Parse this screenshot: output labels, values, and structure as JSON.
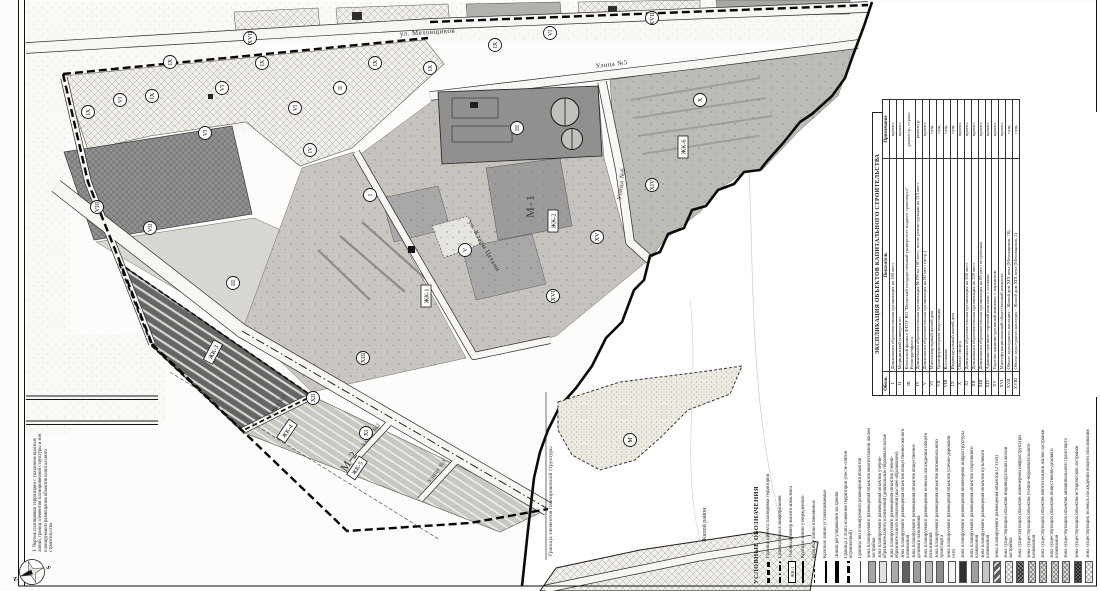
{
  "sheet": {
    "note": "1. Чертеж планировки территории с указанием красных линий, границ элементов планировочной структуры и зон планируемого размещения объектов капитального строительства",
    "compass": {
      "north": "N",
      "south": "S"
    }
  },
  "map": {
    "streets": [
      "ул. Меховщиков",
      "Улица №5",
      "Улица №6",
      "ул. Клары Цеткин",
      "Улица №1",
      "Улица №2",
      "Улица №3"
    ],
    "district_labels": [
      "М-1",
      "М-2"
    ],
    "housing_complex_labels": [
      "ЖК-1",
      "ЖК-2",
      "ЖК-3",
      "ЖК-4",
      "ЖК-5",
      "ЖК-6"
    ],
    "markers": [
      "IX",
      "VI",
      "IX",
      "VI",
      "IX",
      "VI",
      "II",
      "IX",
      "IX",
      "IX",
      "VI",
      "IX",
      "VII",
      "VIII",
      "IV",
      "I",
      "III",
      "V",
      "XVI",
      "XV",
      "XIV",
      "X",
      "XIII",
      "XII",
      "XI",
      "XVII",
      "XVIII",
      "М",
      "III",
      "VI"
    ],
    "annotations": [
      "Жилой район",
      "Граница элементов планировочной структуры"
    ]
  },
  "legend": {
    "title": "УСЛОВНЫЕ ОБОЗНАЧЕНИЯ",
    "items": [
      {
        "label": "Граница проекта планировки территории",
        "swatch": "line-bold-dash"
      },
      {
        "label": "Граница жилых микрорайонов",
        "swatch": "line-dash-dot"
      },
      {
        "label": "Условный номер жилого комплекса",
        "swatch": "zk-box",
        "sample": "ЖК-1"
      },
      {
        "label": "Красные линии утвержденные",
        "swatch": "line-solid"
      },
      {
        "label": "Красные линии отменяемые",
        "swatch": "line-dash-thin"
      },
      {
        "label": "Красные линии устанавливаемые",
        "swatch": "line-solid-thick"
      },
      {
        "label": "Линии регулирования застройки",
        "swatch": "line-bar"
      },
      {
        "label": "Граница 2 этапа освоения территории (после снятия ограничений)",
        "swatch": "line-bold-dash2"
      },
      {
        "label": "Граница зон планируемого размещения объектов",
        "swatch": "line-thin"
      },
      {
        "label": "Зона планируемого размещения объектов многоэтажной жилой застройки",
        "swatch": "fill",
        "fill": "#a6a6a6"
      },
      {
        "label": "Зона планируемого размещения объектов учебно-образовательного назначения (дошкольные образовательные организации)",
        "swatch": "fill",
        "fill": "#e0e0e0"
      },
      {
        "label": "Зона планируемого размещения объектов учебно-образовательного назначения (высшее образование)",
        "swatch": "fill",
        "fill": "#ababab"
      },
      {
        "label": "Зона планируемого размещения объектов общественно-жилого назначения",
        "swatch": "fill",
        "fill": "#606060"
      },
      {
        "label": "Зона планируемого размещения объектов общественно-делового назначения",
        "swatch": "fill",
        "fill": "#9b9b9b"
      },
      {
        "label": "Зона планируемого размещения зеленых насаждений общего пользования",
        "swatch": "fill",
        "fill": "#bcbcbc"
      },
      {
        "label": "Зона планируемого размещения объектов автомобильного транспорта",
        "swatch": "fill",
        "fill": "#8d8d8d"
      },
      {
        "label": "Зона планируемого размещения объектов улично-дорожной сети",
        "swatch": "fill",
        "fill": "#f4f4f4"
      },
      {
        "label": "Зона планируемого размещения инженерной инфраструктуры",
        "swatch": "fill",
        "fill": "#303030"
      },
      {
        "label": "Зона планируемого размещения объектов спортивного назначения",
        "swatch": "fill",
        "fill": "#a0a0a0"
      },
      {
        "label": "Зона планируемого размещения объектов культового назначения",
        "swatch": "fill",
        "fill": "#c6c6c6"
      },
      {
        "label": "Зоны планируемого размещения объектов (2 этап)",
        "swatch": "hatch-stage2"
      },
      {
        "label": "Зона существующих объектов индивидуальной жилой застройки",
        "swatch": "hatch-cross-light"
      },
      {
        "label": "Зона существующих объектов инженерной инфраструктуры",
        "swatch": "hatch-cross-dark"
      },
      {
        "label": "Зона существующих объектов учебно-образовательного назначения",
        "swatch": "hatch-cross-med"
      },
      {
        "label": "Зона существующих объектов многоэтажной жилой застройки",
        "swatch": "hatch-cross-med"
      },
      {
        "label": "Зона существующих объектов общественно-делового назначения",
        "swatch": "hatch-cross-med"
      },
      {
        "label": "Зона существующих объектов автомобильного транспорта",
        "swatch": "hatch-cross-med"
      },
      {
        "label": "Зона существующих объектов исторической застройки",
        "swatch": "hatch-cross-dark2"
      },
      {
        "label": "Зона существующих зеленых насаждений общего пользования",
        "swatch": "hatch-cross-light"
      }
    ]
  },
  "table": {
    "title": "ЭКСПЛИКАЦИЯ ОБЪЕКТОВ КАПИТАЛЬНОГО СТРОИТЕЛЬСТВА",
    "columns": [
      "Обозн.",
      "Показатель",
      "Примечание"
    ],
    "rows": [
      [
        "I",
        "Дошкольная образовательная организация на 180 мест",
        "проект."
      ],
      [
        "II",
        "Медицинский университет",
        "проект."
      ],
      [
        "III",
        "Казанский филиал ФГОУ ВО \"Волжский государственный университет водного транспорта\" Росморречфлота",
        "реконстр., строит."
      ],
      [
        "IV",
        "Дошкольная образовательная организация №190 на 160 мест, после реконструкции на 215 мест",
        "реконстр."
      ],
      [
        "V",
        "Дошкольная образовательная организация на 80 мест (встр.)",
        "проект."
      ],
      [
        "VI",
        "Многоквартирный жилой дом",
        "сущ."
      ],
      [
        "VII",
        "Трансформаторная подстанция",
        "сущ."
      ],
      [
        "VIII",
        "Котельная",
        "сущ."
      ],
      [
        "IX",
        "Индивидуальный жилой дом",
        "сущ."
      ],
      [
        "X",
        "Объект спорта",
        "проект."
      ],
      [
        "XI",
        "Дошкольная образовательная организация на 260 мест",
        "проект."
      ],
      [
        "XII",
        "Дошкольная образовательная организация на 220 мест",
        "проект."
      ],
      [
        "XIII",
        "Дошкольная образовательная организация на 85 мест встроенная",
        "проект."
      ],
      [
        "XIV",
        "Административно-торговый комплекс с отелями",
        "проект."
      ],
      [
        "XV",
        "Торгово-административный комплекс с паркингом",
        "проект."
      ],
      [
        "XVI",
        "Многофункциональный общественный комплекс",
        "проект."
      ],
      [
        "XVII",
        "Объект культурного наследия - Жилой дом XIX века (Меховщиков, 78)",
        "сущ."
      ],
      [
        "XVIII",
        "Объект культурного наследия - Жилой дом XIX века (Меховщиков, 2)",
        "сущ."
      ]
    ]
  }
}
